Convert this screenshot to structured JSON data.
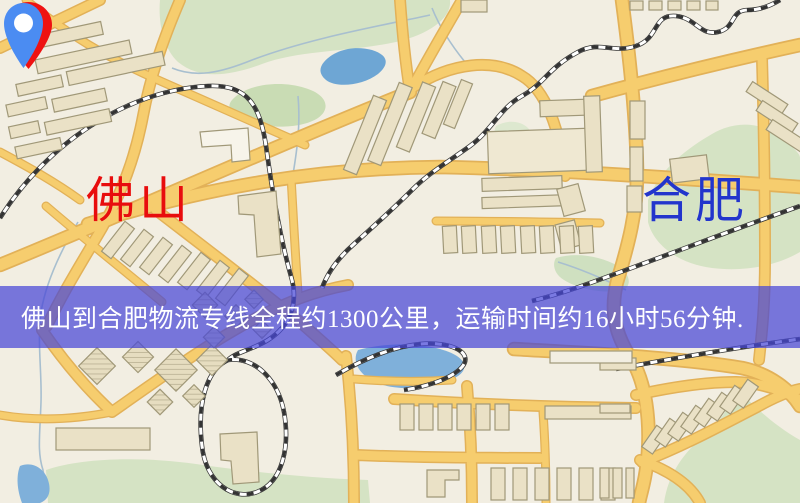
{
  "markers": {
    "origin": {
      "city": "佛山",
      "pin_color": "#ee1212",
      "label_color": "#e80d0d"
    },
    "destination": {
      "city": "合肥",
      "pin_color": "#4b8cf2",
      "label_color": "#2235cc"
    }
  },
  "banner": {
    "text": "佛山到合肥物流专线全程约1300公里，运输时间约16小时56分钟.",
    "route_from": "佛山",
    "route_to": "合肥",
    "distance": "约1300公里",
    "duration": "约16小时56分钟",
    "background": "rgba(70,70,215,0.72)",
    "text_color": "#ffffff"
  },
  "map": {
    "colors": {
      "background": "#f2eee2",
      "road_fill": "#f6cd6e",
      "road_casing": "#e2b158",
      "building": "#eae1c6",
      "building_outline": "#a09878",
      "park": "#d5e3c4",
      "water": "#7fb0da",
      "stream": "#a8bfcf",
      "railway": "#333333"
    }
  }
}
